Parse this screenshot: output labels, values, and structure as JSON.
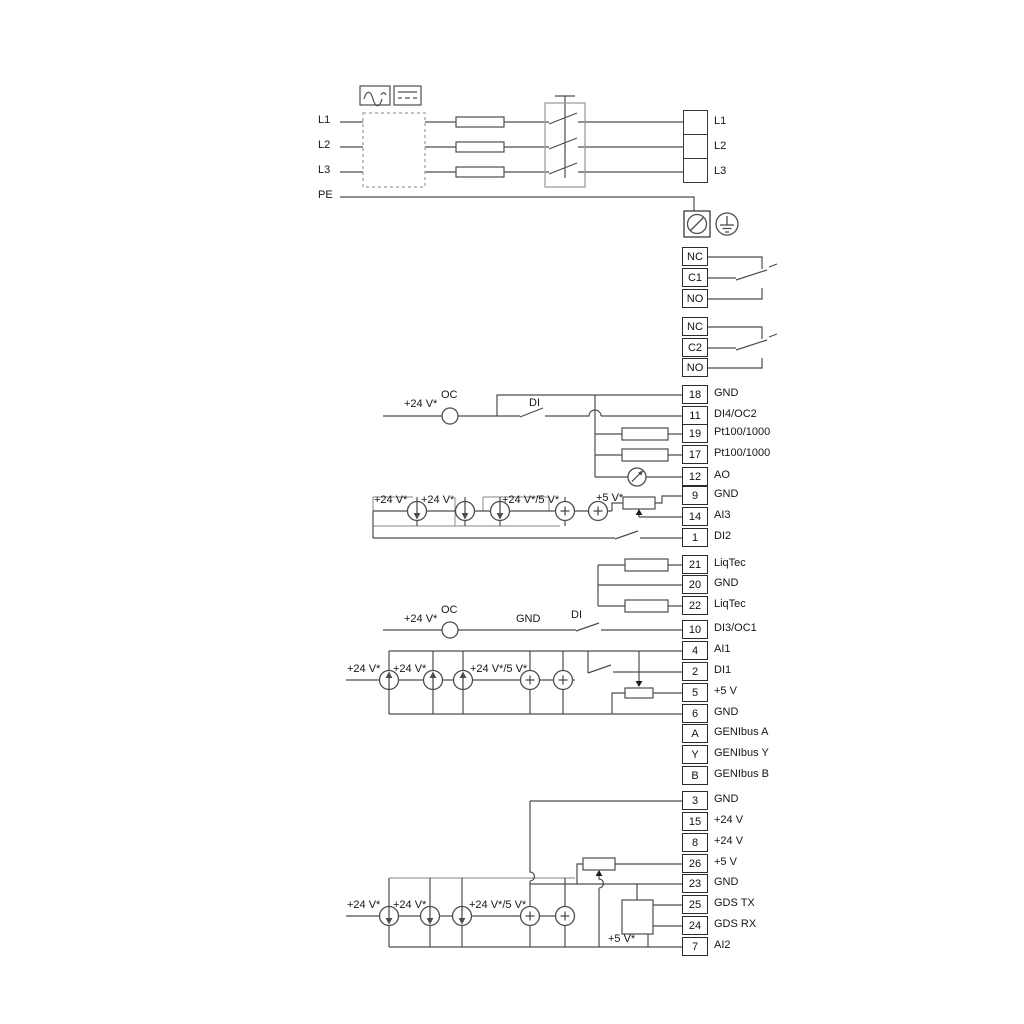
{
  "diagram": {
    "title": "Motor drive terminal wiring diagram"
  },
  "labels": {
    "l1": "L1",
    "l2": "L2",
    "l3": "L3",
    "pe": "PE",
    "p24": "+24 V*",
    "p24_5": "+24 V*/5 V*",
    "p5": "+5 V*",
    "oc": "OC",
    "di": "DI",
    "gnd": "GND"
  },
  "power": {
    "rows": [
      "L1",
      "L2",
      "L3"
    ]
  },
  "relay1": {
    "rows": [
      "NC",
      "C1",
      "NO"
    ]
  },
  "relay2": {
    "rows": [
      "NC",
      "C2",
      "NO"
    ]
  },
  "io": [
    {
      "num": "18",
      "label": "GND"
    },
    {
      "num": "11",
      "label": "DI4/OC2"
    },
    {
      "num": "19",
      "label": "Pt100/1000"
    },
    {
      "num": "17",
      "label": "Pt100/1000"
    },
    {
      "num": "12",
      "label": "AO"
    },
    {
      "num": "9",
      "label": "GND"
    },
    {
      "num": "14",
      "label": "AI3"
    },
    {
      "num": "1",
      "label": "DI2"
    },
    {
      "num": "21",
      "label": "LiqTec"
    },
    {
      "num": "20",
      "label": "GND"
    },
    {
      "num": "22",
      "label": "LiqTec"
    },
    {
      "num": "10",
      "label": "DI3/OC1"
    },
    {
      "num": "4",
      "label": "AI1"
    },
    {
      "num": "2",
      "label": "DI1"
    },
    {
      "num": "5",
      "label": "+5 V"
    },
    {
      "num": "6",
      "label": "GND"
    },
    {
      "num": "A",
      "label": "GENIbus A"
    },
    {
      "num": "Y",
      "label": "GENIbus Y"
    },
    {
      "num": "B",
      "label": "GENIbus B"
    },
    {
      "num": "3",
      "label": "GND"
    },
    {
      "num": "15",
      "label": "+24 V"
    },
    {
      "num": "8",
      "label": "+24 V"
    },
    {
      "num": "26",
      "label": "+5 V"
    },
    {
      "num": "23",
      "label": "GND"
    },
    {
      "num": "25",
      "label": "GDS TX"
    },
    {
      "num": "24",
      "label": "GDS RX"
    },
    {
      "num": "7",
      "label": "AI2"
    }
  ]
}
